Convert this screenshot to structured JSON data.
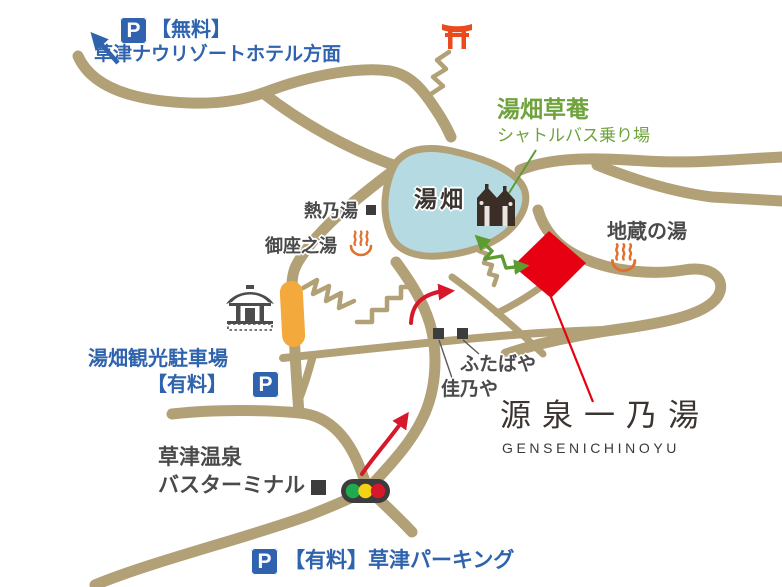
{
  "title": "Kusatsu Onsen access map",
  "colors": {
    "road": "#b2a077",
    "pond": "#b5dae2",
    "destination_red": "#e60012",
    "route_red": "#d7182a",
    "guide_green": "#6fa33c",
    "parking_blue": "#2f63ad",
    "bar_orange": "#f3a93c",
    "landmark_dark": "#3c3c3c",
    "signal_green": "#1faa50",
    "signal_yellow": "#f3d313",
    "signal_red": "#d7182a"
  },
  "icons": {
    "parking_letter": "P",
    "torii": "torii-gate",
    "onsen_mark": "hot-spring-symbol",
    "temple": "temple",
    "guesthouse": "twin-buildings",
    "traffic_light": "traffic-light",
    "landmark_square": "black-square"
  },
  "labels": {
    "free_parking": {
      "fee": "【無料】",
      "dest": "草津ナウリゾートホテル方面"
    },
    "souan": {
      "name": "湯畑草菴",
      "sub": "シャトルバス乗り場"
    },
    "yubatake": "湯畑",
    "netsunoyu": "熱乃湯",
    "gozanoyu": "御座之湯",
    "jizounoyu": "地蔵の湯",
    "sightseeing_parking": {
      "name": "湯畑観光駐車場",
      "fee": "【有料】"
    },
    "futabaya": "ふたばや",
    "kanoya": "佳乃や",
    "gensen": {
      "jp": "源泉一乃湯",
      "en": "GENSENICHINOYU"
    },
    "bus_terminal": {
      "line1": "草津温泉",
      "line2": "バスターミナル"
    },
    "kusatsu_parking": {
      "text": "【有料】草津パーキング"
    }
  }
}
